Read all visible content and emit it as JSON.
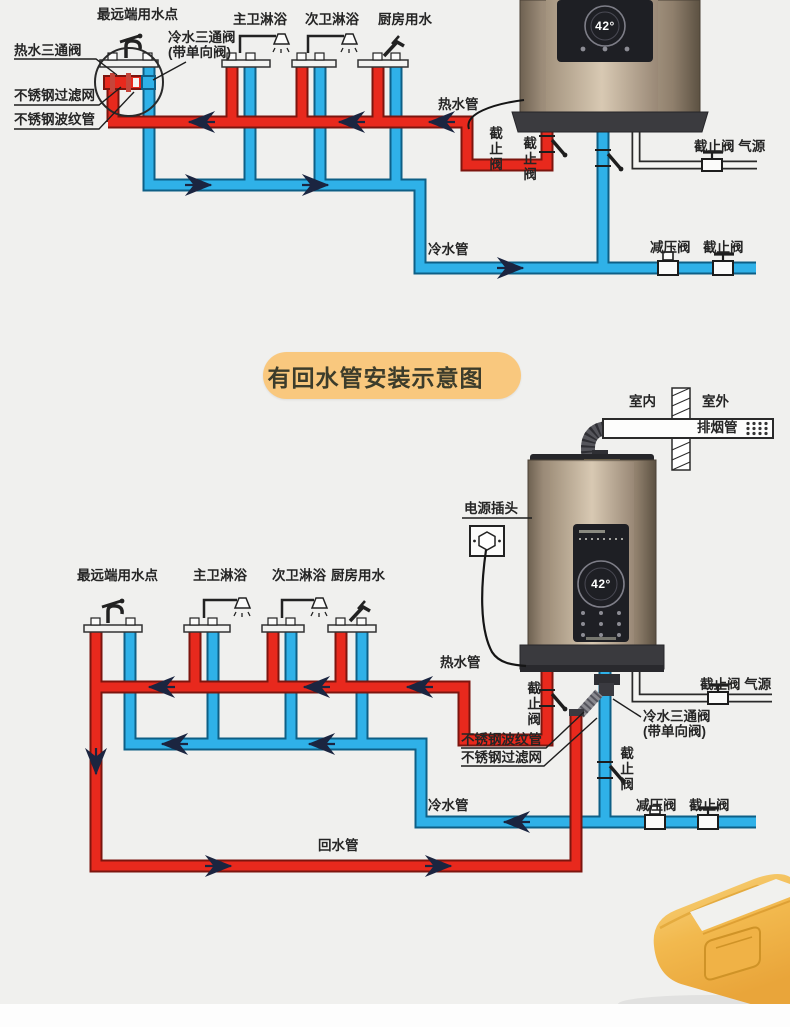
{
  "colors": {
    "hot_pipe": "#e8291d",
    "cold_pipe": "#2fb1e8",
    "badge_bg": "#f9c87e",
    "heater_body": "#a89885",
    "background": "#f0f0ee"
  },
  "section_badge": {
    "title": "有回水管安装示意图"
  },
  "diagram1": {
    "labels": {
      "farthest_outlet": "最远端用水点",
      "hot_three_way_valve": "热水三通阀",
      "cold_three_way_valve": "冷水三通阀",
      "cold_three_way_valve_note": "(带单向阀)",
      "stainless_filter": "不锈钢过滤网",
      "stainless_bellows": "不锈钢波纹管",
      "master_shower": "主卫淋浴",
      "second_shower": "次卫淋浴",
      "kitchen_water": "厨房用水",
      "hot_pipe": "热水管",
      "stop_valve_hot": "截止阀",
      "stop_valve_cold": "截止阀",
      "stop_valve_gas": "截止阀",
      "gas_source": "气源",
      "cold_pipe": "冷水管",
      "pressure_reducing_valve": "减压阀",
      "stop_valve_cold_main": "截止阀"
    },
    "heater": {
      "display_temp": "42°"
    }
  },
  "diagram2": {
    "labels": {
      "indoor": "室内",
      "outdoor": "室外",
      "flue_pipe": "排烟管",
      "power_plug": "电源插头",
      "farthest_outlet": "最远端用水点",
      "master_shower": "主卫淋浴",
      "second_shower": "次卫淋浴",
      "kitchen_water": "厨房用水",
      "hot_pipe": "热水管",
      "stop_valve_hot": "截止阀",
      "stainless_bellows": "不锈钢波纹管",
      "stainless_filter": "不锈钢过滤网",
      "cold_three_way_valve": "冷水三通阀",
      "cold_three_way_valve_note": "(带单向阀)",
      "stop_valve_gas": "截止阀",
      "gas_source": "气源",
      "stop_valve_cold": "截止阀",
      "cold_pipe": "冷水管",
      "pressure_reducing_valve": "减压阀",
      "stop_valve_cold_main": "截止阀",
      "return_pipe": "回水管"
    },
    "heater": {
      "display_temp": "42°"
    }
  }
}
